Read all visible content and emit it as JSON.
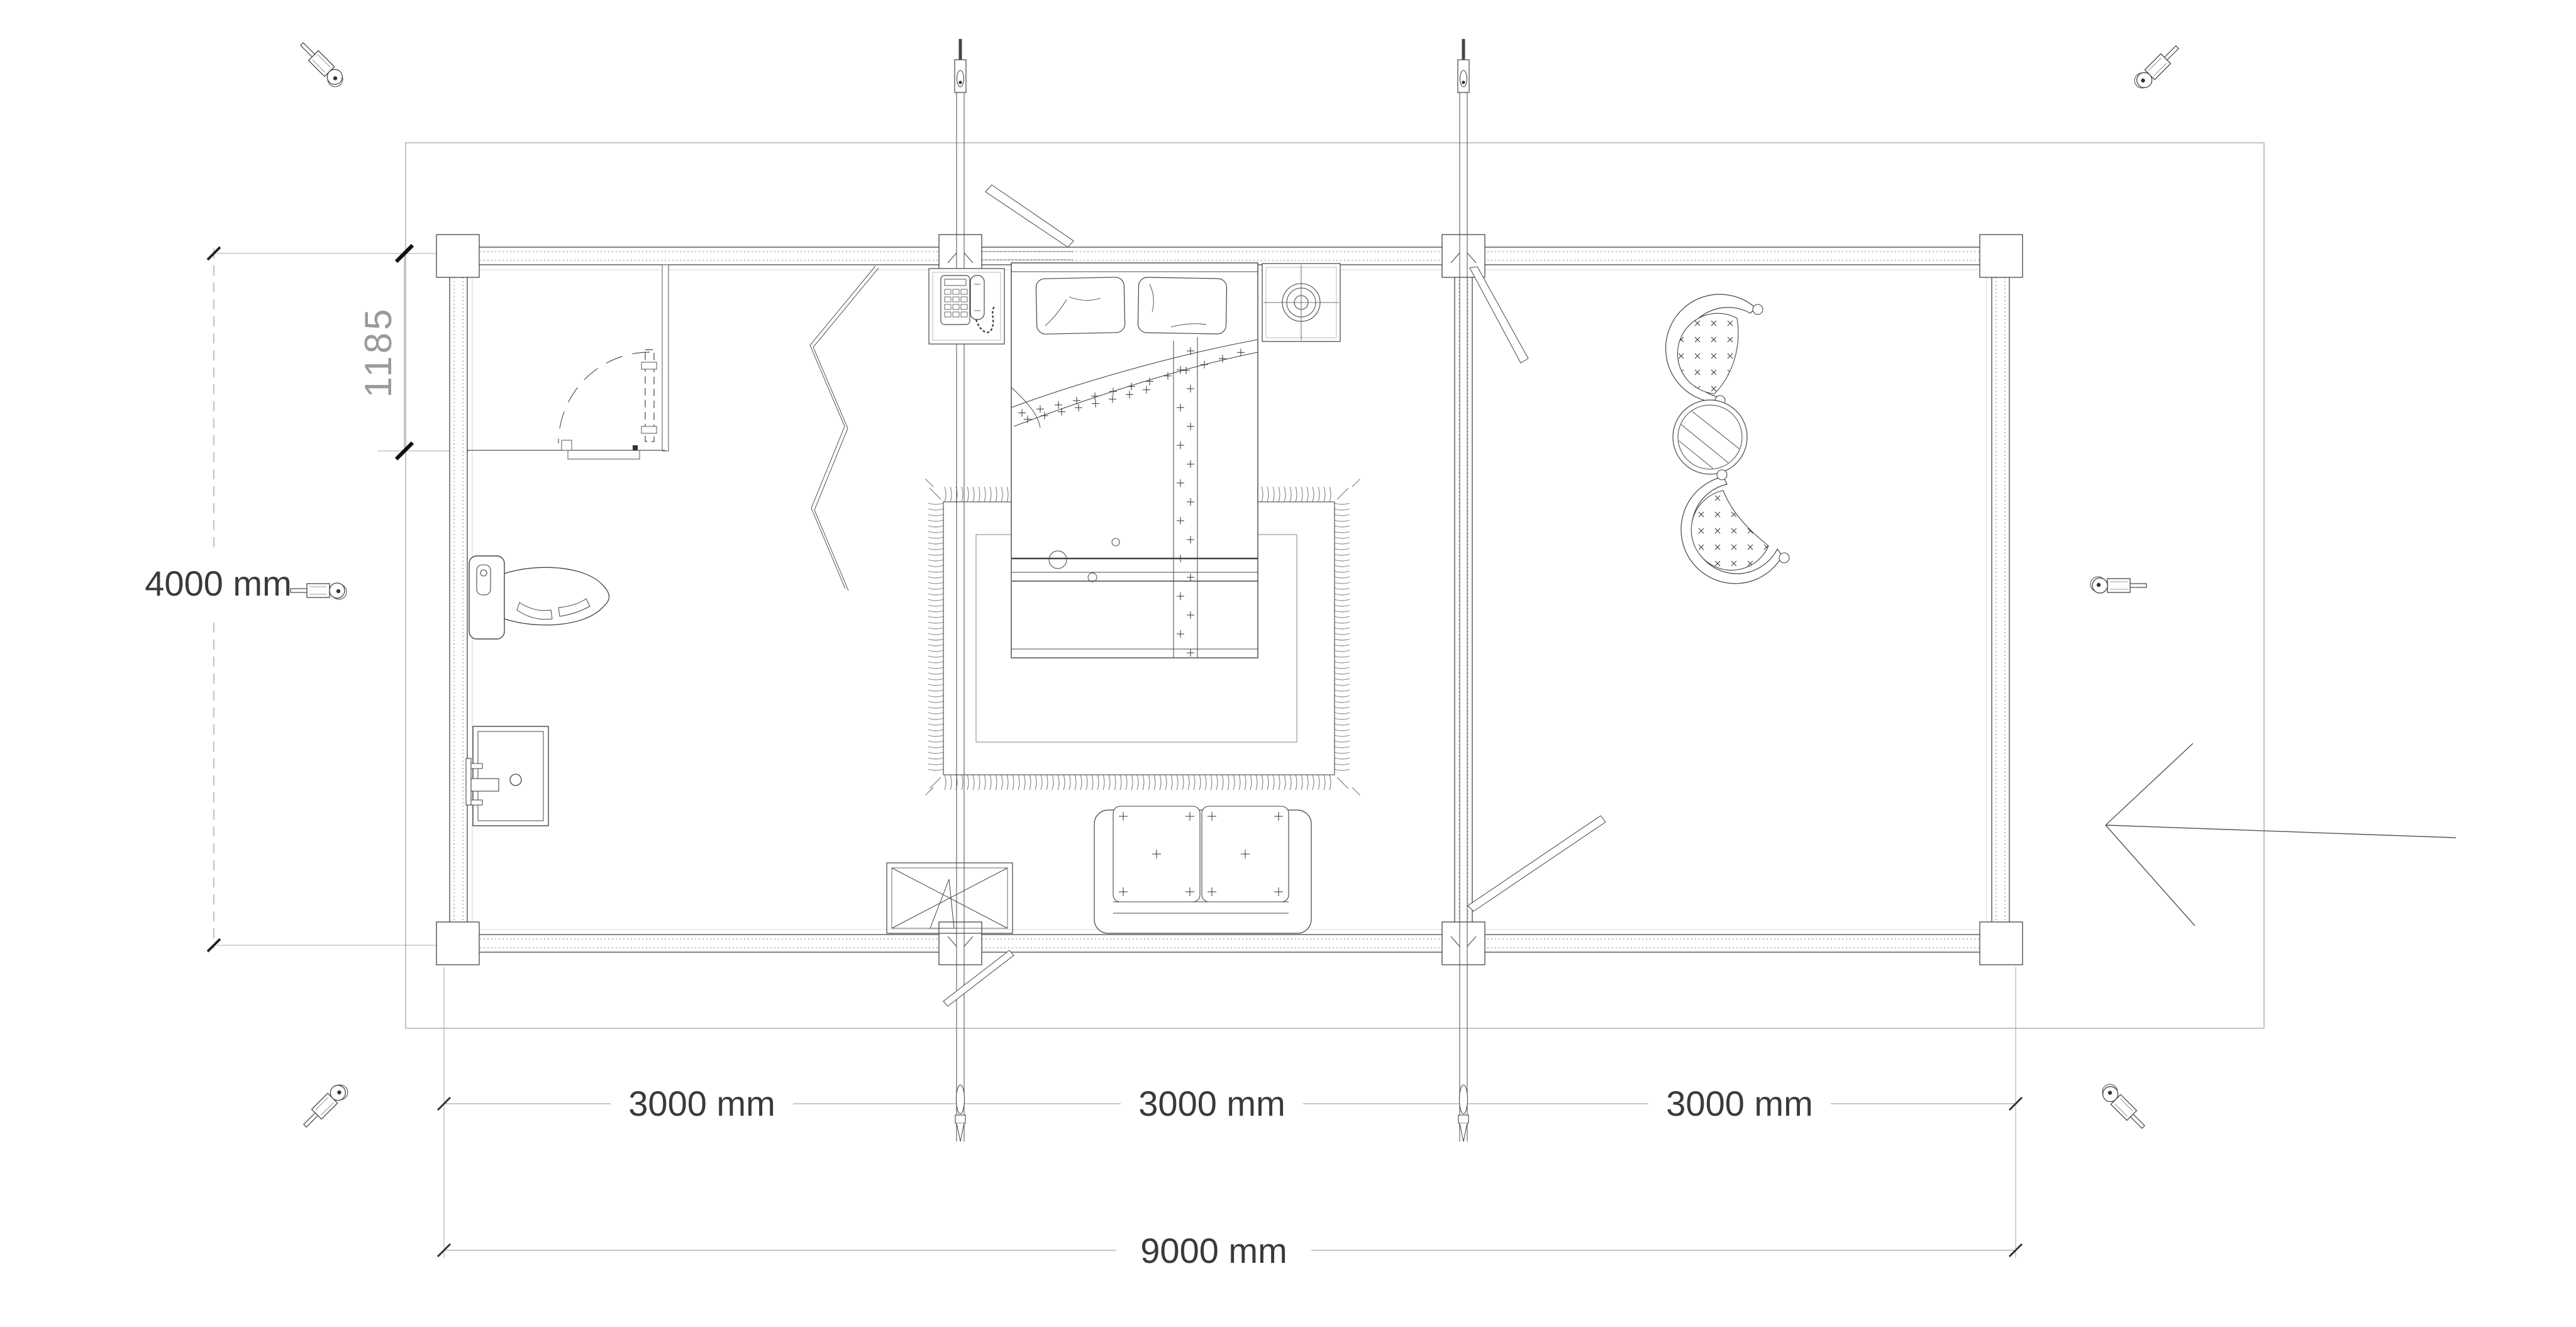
{
  "drawing": {
    "type": "log-cabin-floor-plan",
    "background": "#ffffff",
    "dimensions": {
      "building_height": "4000 mm",
      "bathroom_depth": "1185",
      "bay_segments": [
        "3000 mm",
        "3000 mm",
        "3000 mm"
      ],
      "building_width": "9000 mm"
    },
    "colors": {
      "line": "#444444",
      "dim_line": "#8f8f8f",
      "dim_text": "#3a3a3a",
      "light_text": "#9a9a9a",
      "site_line": "#b5b5b5",
      "hatch": "#bdbdbd"
    },
    "icons": [
      "storm-brace-tool-icon",
      "storm-brace-rod-icon",
      "entrance-arrow-icon"
    ],
    "furniture": [
      "double-bed",
      "pillow",
      "bed-runner",
      "fringed-rug",
      "sofa",
      "window-box",
      "toilet",
      "washbasin",
      "telephone-table",
      "lamp-table",
      "papasan-chair",
      "round-glass-table",
      "folding-screen",
      "interior-door"
    ]
  }
}
